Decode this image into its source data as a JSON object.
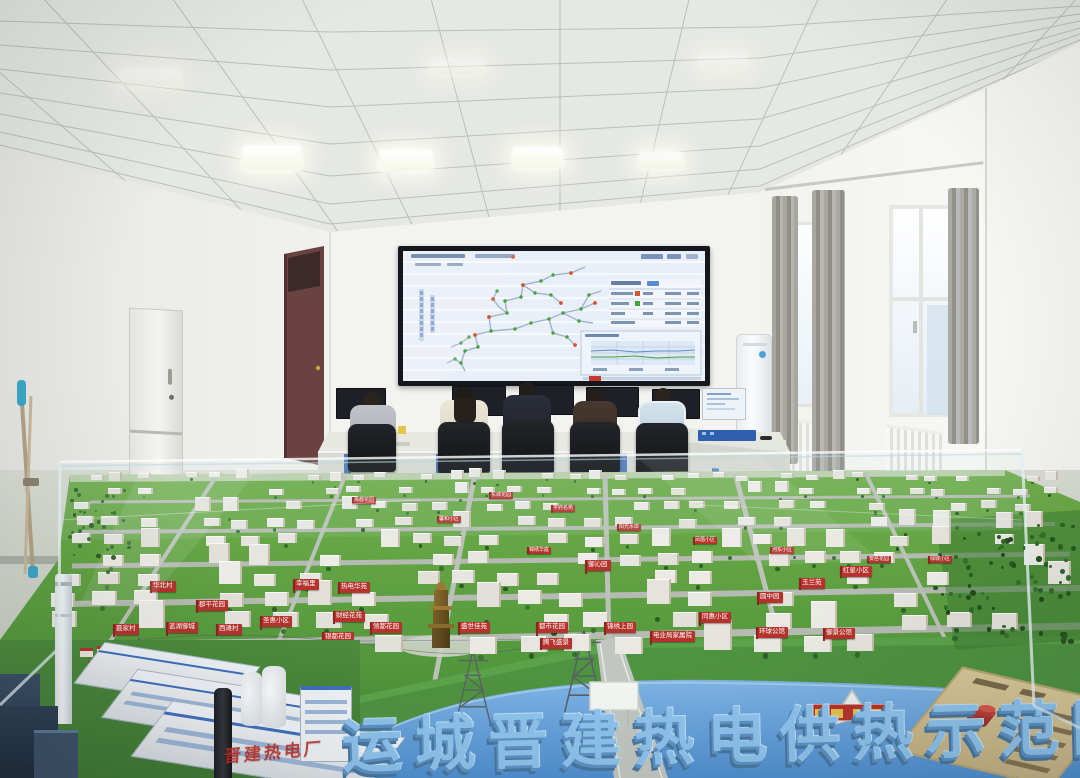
{
  "model": {
    "plate_text": "运城晋建热电供热示范园",
    "glass_banner_text": "晋建热电厂",
    "signs": [
      {
        "label": "禹都花园",
        "x": 352,
        "y": 497
      },
      {
        "label": "东城花园",
        "x": 489,
        "y": 492
      },
      {
        "label": "学府名苑",
        "x": 551,
        "y": 505
      },
      {
        "label": "馨和小区",
        "x": 437,
        "y": 516
      },
      {
        "label": "阳光水岸",
        "x": 617,
        "y": 524
      },
      {
        "label": "凤凰小区",
        "x": 693,
        "y": 537
      },
      {
        "label": "河东小区",
        "x": 770,
        "y": 547
      },
      {
        "label": "安邑花园",
        "x": 867,
        "y": 556
      },
      {
        "label": "绿城小区",
        "x": 928,
        "y": 556
      },
      {
        "label": "红星小区",
        "x": 840,
        "y": 566
      },
      {
        "label": "锦绣华庭",
        "x": 527,
        "y": 547
      },
      {
        "label": "御沁园",
        "x": 585,
        "y": 560
      },
      {
        "label": "玉兰苑",
        "x": 799,
        "y": 578
      },
      {
        "label": "圆中园",
        "x": 757,
        "y": 592
      },
      {
        "label": "同惠小区",
        "x": 699,
        "y": 612
      },
      {
        "label": "环球公馆",
        "x": 756,
        "y": 627
      },
      {
        "label": "御景公馆",
        "x": 823,
        "y": 628
      },
      {
        "label": "电业局家属院",
        "x": 650,
        "y": 631
      },
      {
        "label": "华北村",
        "x": 150,
        "y": 581
      },
      {
        "label": "郡平花园",
        "x": 196,
        "y": 600
      },
      {
        "label": "幸福里",
        "x": 293,
        "y": 579
      },
      {
        "label": "热电华苑",
        "x": 338,
        "y": 582
      },
      {
        "label": "财经花苑",
        "x": 333,
        "y": 611
      },
      {
        "label": "圣惠小区",
        "x": 260,
        "y": 616
      },
      {
        "label": "银都花园",
        "x": 322,
        "y": 632
      },
      {
        "label": "领都花园",
        "x": 370,
        "y": 622
      },
      {
        "label": "蓝湖御城",
        "x": 166,
        "y": 622
      },
      {
        "label": "西滩村",
        "x": 216,
        "y": 624
      },
      {
        "label": "聂家村",
        "x": 113,
        "y": 624
      },
      {
        "label": "李店村",
        "x": 95,
        "y": 643
      },
      {
        "label": "杜家村",
        "x": 137,
        "y": 643
      },
      {
        "label": "盛世佳苑",
        "x": 458,
        "y": 622
      },
      {
        "label": "都市花园",
        "x": 536,
        "y": 622
      },
      {
        "label": "腾飞盛景",
        "x": 540,
        "y": 638
      },
      {
        "label": "锦绣上园",
        "x": 604,
        "y": 622
      }
    ]
  },
  "colors": {
    "sign_red": "#b5332c",
    "sign_pole": "#8e2420",
    "model_green": "#579b3e",
    "river_blue": "#5d9bd8",
    "plate_blue": "#8ec3ec",
    "screen_bg": "#e9eff8",
    "node_green": "#41a33e",
    "node_alarm": "#d4552e"
  }
}
